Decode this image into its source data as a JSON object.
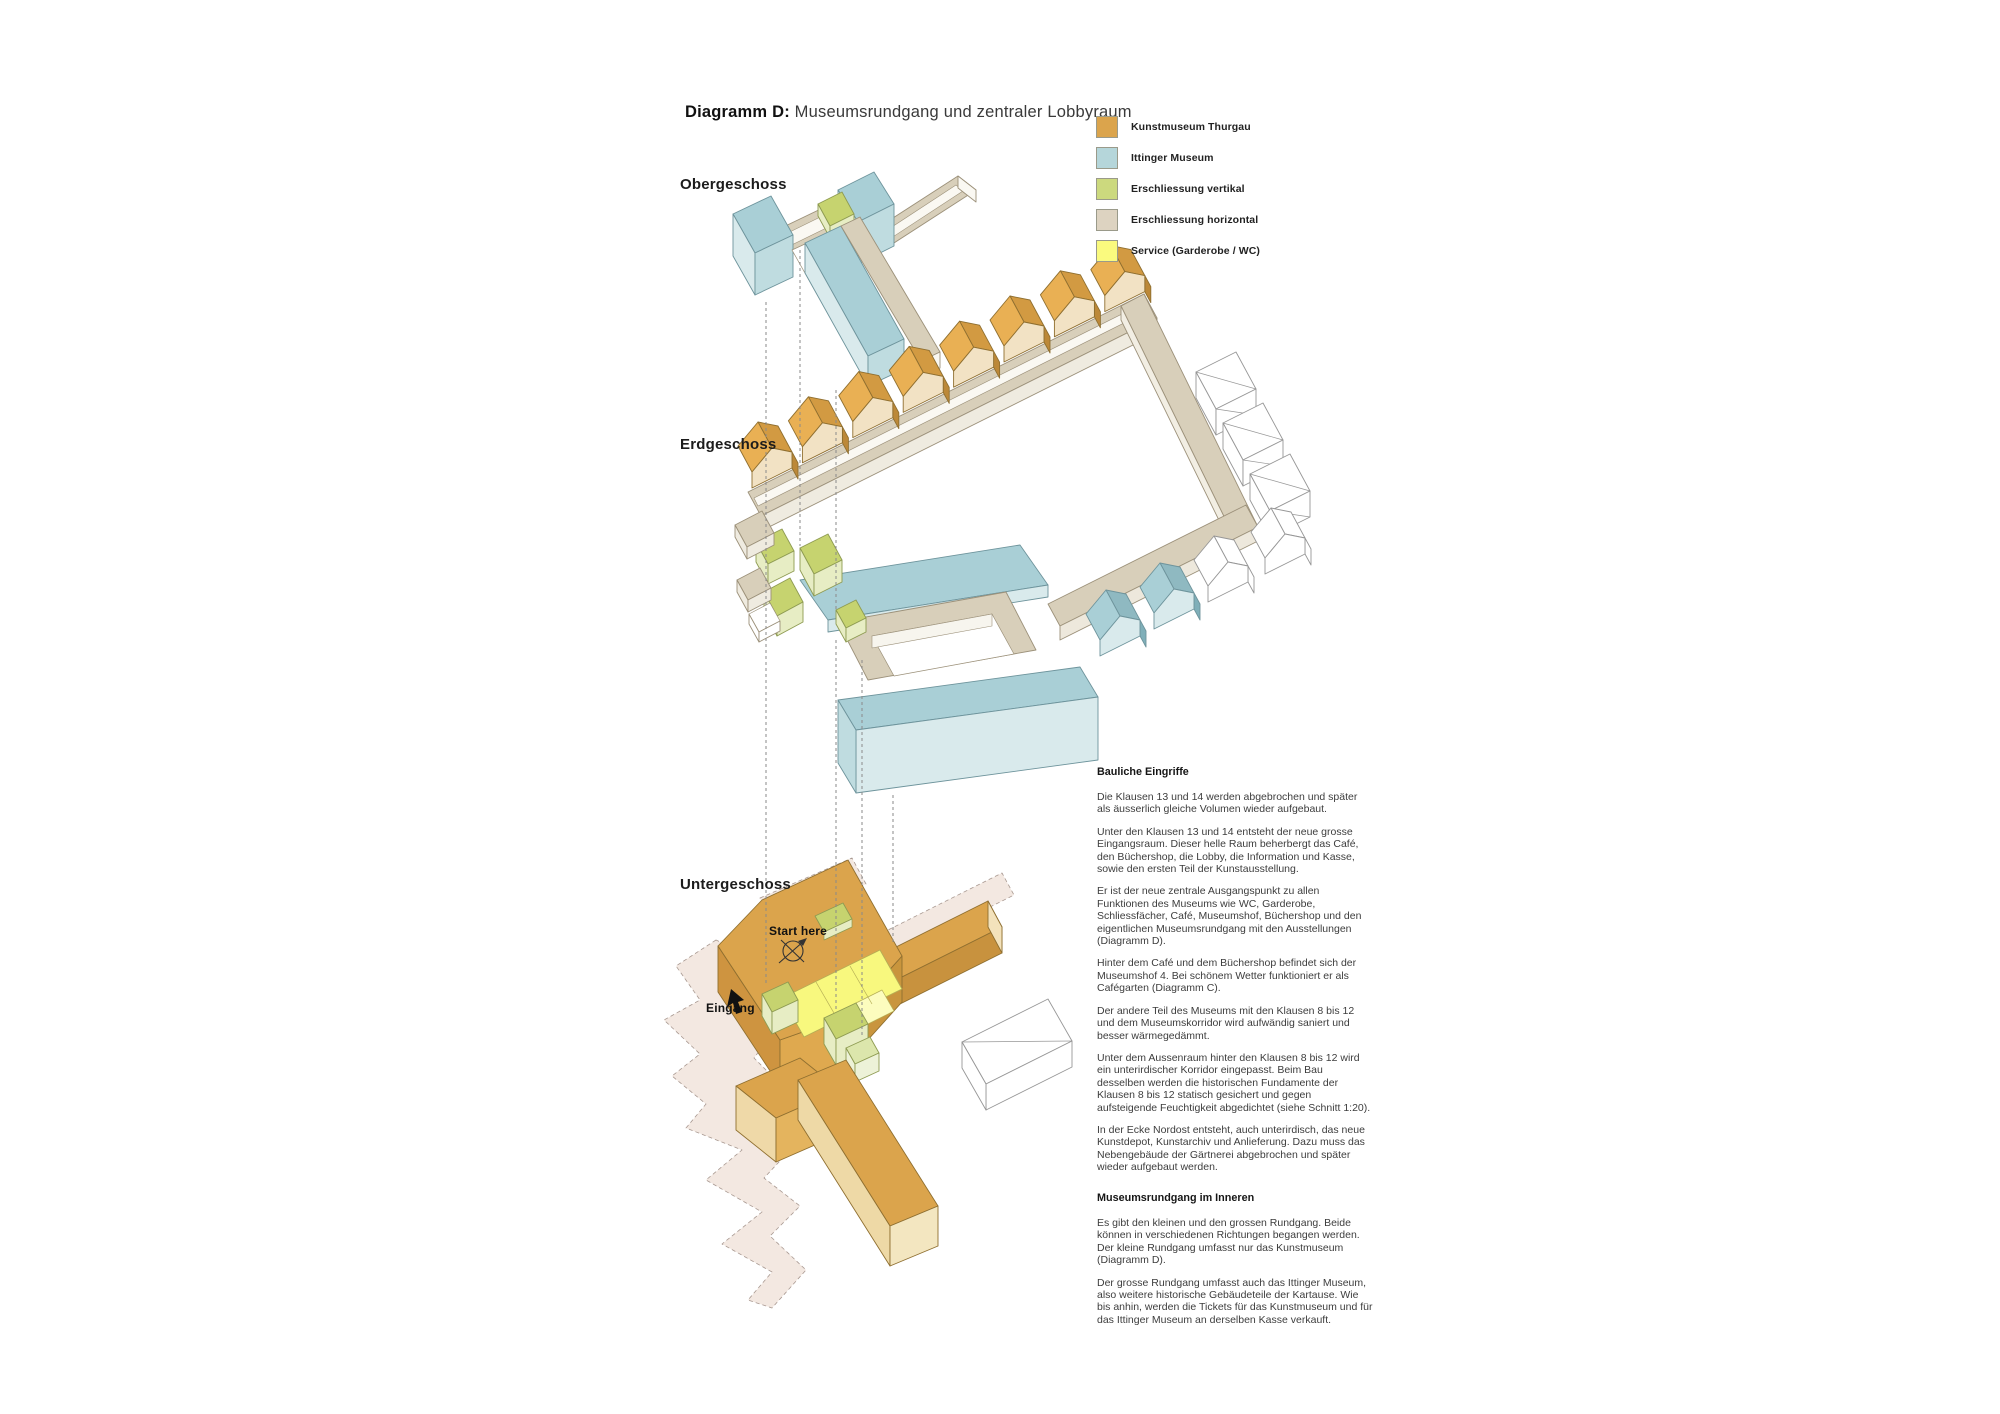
{
  "title": {
    "prefix": "Diagramm D:",
    "text": " Museumsrundgang und zentraler Lobbyraum"
  },
  "legend": {
    "items": [
      {
        "label": "Kunstmuseum Thurgau",
        "color": "#DBA44C"
      },
      {
        "label": "Ittinger Museum",
        "color": "#B5D6DA"
      },
      {
        "label": "Erschliessung vertikal",
        "color": "#CCD97E"
      },
      {
        "label": "Erschliessung horizontal",
        "color": "#DDD3C1"
      },
      {
        "label": "Service (Garderobe / WC)",
        "color": "#FAFA7E"
      }
    ]
  },
  "floors": {
    "upper": "Obergeschoss",
    "ground": "Erdgeschoss",
    "lower": "Untergeschoss"
  },
  "annotations": {
    "start": "Start here",
    "entrance": "Eingang"
  },
  "sections": [
    {
      "heading": "Bauliche Eingriffe",
      "paragraphs": [
        "Die Klausen 13 und 14 werden abgebrochen und später als äusserlich gleiche Volumen wieder aufgebaut.",
        "Unter den Klausen 13 und 14 entsteht der neue grosse Eingangsraum. Dieser helle Raum beherbergt das Café, den Büchershop, die Lobby, die Information und Kasse, sowie den ersten Teil der Kunstausstellung.",
        "Er ist der neue zentrale Ausgangspunkt zu allen Funktionen des Museums wie WC, Garderobe, Schliessfächer, Café, Museumshof, Büchershop und den eigentlichen Museumsrundgang mit den Ausstellungen (Diagramm D).",
        "Hinter dem Café und dem Büchershop befindet sich der Museumshof 4. Bei schönem Wetter funktioniert er als Cafégarten (Diagramm C).",
        "Der andere Teil des Museums mit den Klausen 8 bis 12 und dem Museumskorridor wird aufwändig saniert und besser wärmegedämmt.",
        "Unter dem Aussenraum hinter den Klausen 8 bis 12 wird ein unterirdischer Korridor eingepasst. Beim Bau desselben werden die historischen Fundamente der Klausen 8 bis 12 statisch gesichert und gegen aufsteigende Feuchtigkeit abgedichtet (siehe Schnitt 1:20).",
        "In der Ecke Nordost entsteht, auch unterirdisch, das neue Kunstdepot, Kunstarchiv und Anlieferung. Dazu muss das Nebengebäude der Gärtnerei abgebrochen und später wieder aufgebaut werden."
      ]
    },
    {
      "heading": "Museumsrundgang im Inneren",
      "paragraphs": [
        "Es gibt den kleinen und den grossen Rundgang. Beide können in verschiedenen Richtungen begangen werden. Der kleine Rundgang umfasst nur das Kunstmuseum (Diagramm D).",
        "Der grosse Rundgang umfasst auch das Ittinger Museum, also weitere historische Gebäudeteile der Kartause. Wie bis anhin, werden die Tickets für das Kunstmuseum und für das Ittinger Museum an derselben Kasse verkauft."
      ]
    }
  ]
}
